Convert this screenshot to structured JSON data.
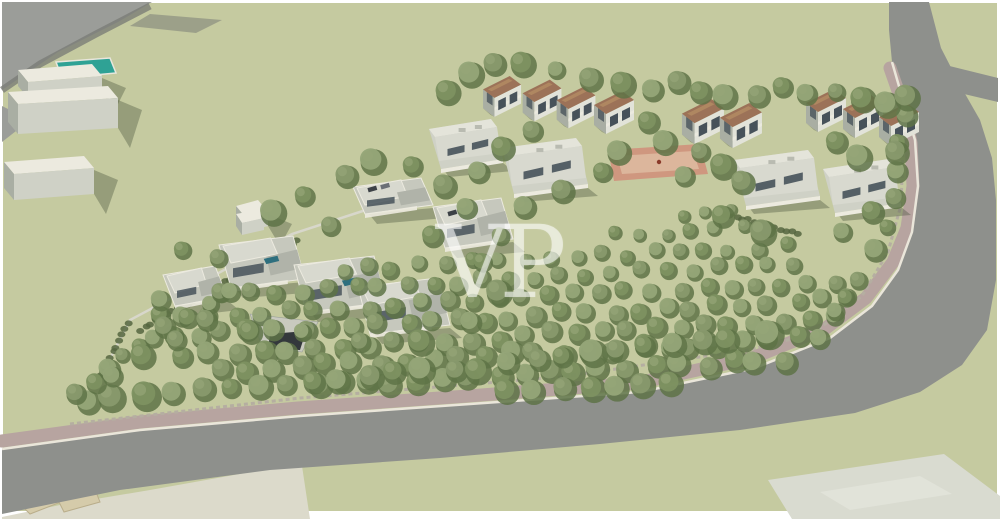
{
  "meta": {
    "description": "3D aerial architectural rendering of a residential masterplan: olive-tree orchard, perimeter road with pink sidewalk and dry-stone wall, two-storey terraced houses with terracotta roofs, single-storey patio houses, modern flat-roof villas, red plaza, pool and existing white buildings outside the site",
    "watermark_text": "VP"
  },
  "palette": {
    "frame": "#ffffff",
    "ground": "#c5caa0",
    "road": "#8e908c",
    "road_far": "#9b9d99",
    "road_edge_dark": "#7a7d77",
    "sidewalk": "#b7a4a0",
    "curb": "#eae6da",
    "stone_wall": "#b5aea1",
    "pale_field": "#dcdacb",
    "pad": "#d9dbd0",
    "pad_line": "#e6e8df",
    "pool": "#2fa295",
    "pool_rim": "#e8e6dc",
    "plaza_border": "#cf977f",
    "plaza_inner": "#dcb69c",
    "plaza_dot": "#8a3a2a",
    "white_wall": "#eceadf",
    "light_wall": "#e2e3d9",
    "mid_wall": "#cfd1c6",
    "dark_wall": "#a9aea3",
    "shadow_wall": "#9ba199",
    "window_dark": "#47525a",
    "roof_brown": "#9c7258",
    "roof_brown_light": "#b18a63",
    "roof_flat_light": "#e4e4da",
    "roof_flat": "#d8d9cf",
    "roof_deck": "#c6c8bd",
    "ruin": "#d5cbaa",
    "ruin_dark": "#b9ad8a",
    "tree_dark": "#5e7347",
    "tree_mid": "#7d9161",
    "tree_mid2": "#88996d",
    "tree_light": "#95a578",
    "hedge": "#55663f",
    "ramp_dark": "#33383c",
    "ramp_wall": "#c9cabf",
    "wall_line": "#d9d8cf",
    "car_dark": "#3c4146",
    "car_gray": "#6b7076",
    "shadow": "rgba(74,84,60,0.38)"
  },
  "scene": {
    "watermark": {
      "text": "VP"
    },
    "ground_rect": [
      3,
      3,
      994,
      508
    ],
    "roads": {
      "main_outer": [
        [
          929,
          2
        ],
        [
          941,
          48
        ],
        [
          960,
          85
        ],
        [
          980,
          120
        ],
        [
          992,
          158
        ],
        [
          996,
          200
        ],
        [
          996,
          280
        ],
        [
          987,
          330
        ],
        [
          962,
          365
        ],
        [
          920,
          392
        ],
        [
          855,
          413
        ],
        [
          740,
          430
        ],
        [
          600,
          444
        ],
        [
          440,
          458
        ],
        [
          270,
          470
        ],
        [
          120,
          490
        ],
        [
          2,
          514
        ]
      ],
      "main_inner": [
        [
          2,
          449
        ],
        [
          140,
          430
        ],
        [
          300,
          416
        ],
        [
          470,
          404
        ],
        [
          640,
          392
        ],
        [
          755,
          368
        ],
        [
          830,
          338
        ],
        [
          872,
          306
        ],
        [
          898,
          270
        ],
        [
          912,
          232
        ],
        [
          918,
          186
        ],
        [
          915,
          140
        ],
        [
          903,
          100
        ],
        [
          892,
          62
        ],
        [
          889,
          30
        ],
        [
          889,
          2
        ]
      ],
      "branch": [
        [
          905,
          55
        ],
        [
          998,
          78
        ],
        [
          998,
          102
        ],
        [
          913,
          82
        ]
      ],
      "sidewalk": [
        [
          890,
          68
        ],
        [
          903,
          105
        ],
        [
          911,
          143
        ],
        [
          913,
          186
        ],
        [
          907,
          228
        ],
        [
          893,
          262
        ],
        [
          866,
          298
        ],
        [
          826,
          328
        ],
        [
          752,
          358
        ],
        [
          638,
          383
        ],
        [
          468,
          396
        ],
        [
          298,
          408
        ],
        [
          140,
          422
        ],
        [
          2,
          441
        ]
      ],
      "stone_wall": [
        [
          70,
          424
        ],
        [
          300,
          398
        ],
        [
          560,
          377
        ],
        [
          748,
          350
        ],
        [
          812,
          334
        ],
        [
          862,
          296
        ],
        [
          888,
          252
        ],
        [
          901,
          205
        ],
        [
          903,
          150
        ]
      ],
      "topleft_wedge": [
        [
          2,
          2
        ],
        [
          152,
          2
        ],
        [
          118,
          22
        ],
        [
          58,
          52
        ],
        [
          2,
          90
        ]
      ],
      "topleft_edge": [
        [
          150,
          6
        ],
        [
          96,
          34
        ],
        [
          40,
          64
        ],
        [
          2,
          90
        ]
      ],
      "shadow_streak": [
        [
          150,
          14
        ],
        [
          222,
          20
        ],
        [
          196,
          33
        ],
        [
          130,
          26
        ]
      ],
      "left_sliver": [
        [
          2,
          106
        ],
        [
          30,
          120
        ],
        [
          2,
          142
        ]
      ]
    },
    "offsite": {
      "pale_field": [
        [
          2,
          517
        ],
        [
          60,
          505
        ],
        [
          150,
          490
        ],
        [
          262,
          470
        ],
        [
          302,
          466
        ],
        [
          310,
          519
        ],
        [
          2,
          519
        ]
      ],
      "pad": [
        [
          768,
          480
        ],
        [
          944,
          454
        ],
        [
          1000,
          496
        ],
        [
          1000,
          519
        ],
        [
          792,
          519
        ]
      ],
      "pad_inner": [
        [
          820,
          492
        ],
        [
          920,
          476
        ],
        [
          952,
          494
        ],
        [
          850,
          510
        ]
      ],
      "pool": [
        [
          56,
          62
        ],
        [
          110,
          58
        ],
        [
          116,
          73
        ],
        [
          62,
          78
        ]
      ],
      "boxes": [
        {
          "x": 18,
          "y": 70,
          "w": 74,
          "hf": 16
        },
        {
          "x": 8,
          "y": 92,
          "w": 100,
          "hf": 30
        },
        {
          "x": 4,
          "y": 162,
          "w": 80,
          "hf": 26
        },
        {
          "x": 236,
          "y": 206,
          "w": 22,
          "hf": 14
        }
      ],
      "ruins": [
        [
          [
            8,
            492
          ],
          [
            60,
            478
          ],
          [
            70,
            486
          ],
          [
            18,
            502
          ]
        ],
        [
          [
            18,
            502
          ],
          [
            70,
            486
          ],
          [
            66,
            500
          ],
          [
            30,
            514
          ]
        ],
        [
          [
            58,
            500
          ],
          [
            96,
            492
          ],
          [
            100,
            502
          ],
          [
            64,
            512
          ]
        ]
      ]
    },
    "site": {
      "plaza_outer": [
        [
          608,
          150
        ],
        [
          700,
          144
        ],
        [
          708,
          174
        ],
        [
          614,
          181
        ]
      ],
      "plaza_inner": [
        [
          617,
          156
        ],
        [
          693,
          151
        ],
        [
          699,
          169
        ],
        [
          622,
          174
        ]
      ],
      "plaza_dot": [
        659,
        162
      ],
      "ramp_walls": [
        [
          250,
          314
        ],
        [
          318,
          322
        ],
        [
          302,
          352
        ],
        [
          262,
          346
        ]
      ],
      "ramp_dark": [
        [
          270,
          334
        ],
        [
          306,
          331
        ],
        [
          300,
          350
        ],
        [
          268,
          349
        ]
      ],
      "wall_line": [
        [
          95,
          388
        ],
        [
          130,
          320
        ],
        [
          292,
          234
        ],
        [
          372,
          208
        ]
      ],
      "hedges": [
        [
          [
            140,
            330
          ],
          [
            298,
            240
          ]
        ],
        [
          [
            718,
            212
          ],
          [
            798,
            234
          ]
        ],
        [
          [
            95,
            386
          ],
          [
            128,
            324
          ]
        ]
      ]
    },
    "buildings": {
      "townhouses": [
        {
          "x": 503,
          "y": 96,
          "s": 0.95
        },
        {
          "x": 543,
          "y": 100,
          "s": 0.97
        },
        {
          "x": 577,
          "y": 107,
          "s": 0.97
        },
        {
          "x": 615,
          "y": 112,
          "s": 1.0
        },
        {
          "x": 704,
          "y": 121,
          "s": 1.05
        },
        {
          "x": 742,
          "y": 125,
          "s": 1.05
        },
        {
          "x": 827,
          "y": 110,
          "s": 1.0
        },
        {
          "x": 864,
          "y": 116,
          "s": 1.0
        },
        {
          "x": 900,
          "y": 124,
          "s": 1.0
        }
      ],
      "patio_houses": [
        {
          "x": 466,
          "y": 144,
          "w": 74,
          "h": 50
        },
        {
          "x": 545,
          "y": 166,
          "w": 86,
          "h": 56
        },
        {
          "x": 777,
          "y": 178,
          "w": 86,
          "h": 56
        },
        {
          "x": 862,
          "y": 186,
          "w": 78,
          "h": 54
        }
      ],
      "villas": [
        {
          "x": 393,
          "y": 196,
          "w": 80,
          "h": 36,
          "cars": true
        },
        {
          "x": 473,
          "y": 223,
          "w": 80,
          "h": 50,
          "cars": true
        },
        {
          "x": 262,
          "y": 262,
          "w": 86,
          "h": 52,
          "pool": true
        },
        {
          "x": 340,
          "y": 284,
          "w": 92,
          "h": 56,
          "pool": true
        },
        {
          "x": 404,
          "y": 306,
          "w": 92,
          "h": 56
        },
        {
          "x": 195,
          "y": 286,
          "w": 64,
          "h": 40
        }
      ]
    },
    "trees": {
      "orchard": {
        "poly": [
          [
            132,
            320
          ],
          [
            250,
            282
          ],
          [
            430,
            255
          ],
          [
            585,
            238
          ],
          [
            668,
            206
          ],
          [
            737,
            201
          ],
          [
            800,
            238
          ],
          [
            848,
            296
          ],
          [
            832,
            352
          ],
          [
            720,
            382
          ],
          [
            540,
            394
          ],
          [
            340,
            392
          ],
          [
            175,
            362
          ]
        ],
        "y0": 204,
        "y1": 396,
        "row_h": 19,
        "col_w": 26
      },
      "rows": [
        {
          "pts": [
            [
              85,
              400
            ],
            [
              200,
              388
            ],
            [
              340,
              378
            ],
            [
              480,
              368
            ],
            [
              620,
              352
            ],
            [
              730,
              338
            ],
            [
              798,
              327
            ]
          ],
          "spacing": 31,
          "r": 12
        },
        {
          "pts": [
            [
              905,
              118
            ],
            [
              898,
              170
            ],
            [
              885,
              225
            ],
            [
              862,
              280
            ],
            [
              832,
              314
            ],
            [
              802,
              331
            ]
          ],
          "spacing": 27,
          "r": 10
        },
        {
          "pts": [
            [
              78,
              392
            ],
            [
              122,
              358
            ],
            [
              166,
              329
            ],
            [
              206,
              304
            ],
            [
              242,
              284
            ]
          ],
          "spacing": 20,
          "r": 9
        }
      ],
      "scattered": [
        [
          447,
          92
        ],
        [
          470,
          74
        ],
        [
          494,
          64
        ],
        [
          522,
          64
        ],
        [
          556,
          70
        ],
        [
          590,
          79
        ],
        [
          622,
          84
        ],
        [
          652,
          90
        ],
        [
          678,
          82
        ],
        [
          700,
          92
        ],
        [
          724,
          96
        ],
        [
          758,
          96
        ],
        [
          782,
          87
        ],
        [
          806,
          94
        ],
        [
          836,
          92
        ],
        [
          862,
          99
        ],
        [
          886,
          104
        ],
        [
          906,
          97
        ],
        [
          648,
          122
        ],
        [
          664,
          142
        ],
        [
          700,
          152
        ],
        [
          722,
          166
        ],
        [
          618,
          152
        ],
        [
          532,
          131
        ],
        [
          502,
          148
        ],
        [
          478,
          172
        ],
        [
          444,
          186
        ],
        [
          412,
          166
        ],
        [
          372,
          161
        ],
        [
          346,
          176
        ],
        [
          304,
          196
        ],
        [
          272,
          212
        ],
        [
          330,
          226
        ],
        [
          432,
          236
        ],
        [
          524,
          207
        ],
        [
          562,
          191
        ],
        [
          602,
          172
        ],
        [
          684,
          176
        ],
        [
          742,
          182
        ],
        [
          836,
          142
        ],
        [
          858,
          157
        ],
        [
          896,
          152
        ],
        [
          872,
          212
        ],
        [
          842,
          232
        ],
        [
          762,
          232
        ],
        [
          722,
          216
        ],
        [
          466,
          208
        ],
        [
          500,
          236
        ],
        [
          182,
          250
        ],
        [
          160,
          300
        ],
        [
          206,
          320
        ],
        [
          250,
          332
        ],
        [
          302,
          332
        ],
        [
          360,
          342
        ],
        [
          420,
          342
        ],
        [
          470,
          322
        ],
        [
          498,
          292
        ],
        [
          482,
          262
        ],
        [
          230,
          292
        ],
        [
          176,
          340
        ],
        [
          142,
          356
        ],
        [
          112,
          376
        ],
        [
          218,
          258
        ]
      ]
    }
  }
}
